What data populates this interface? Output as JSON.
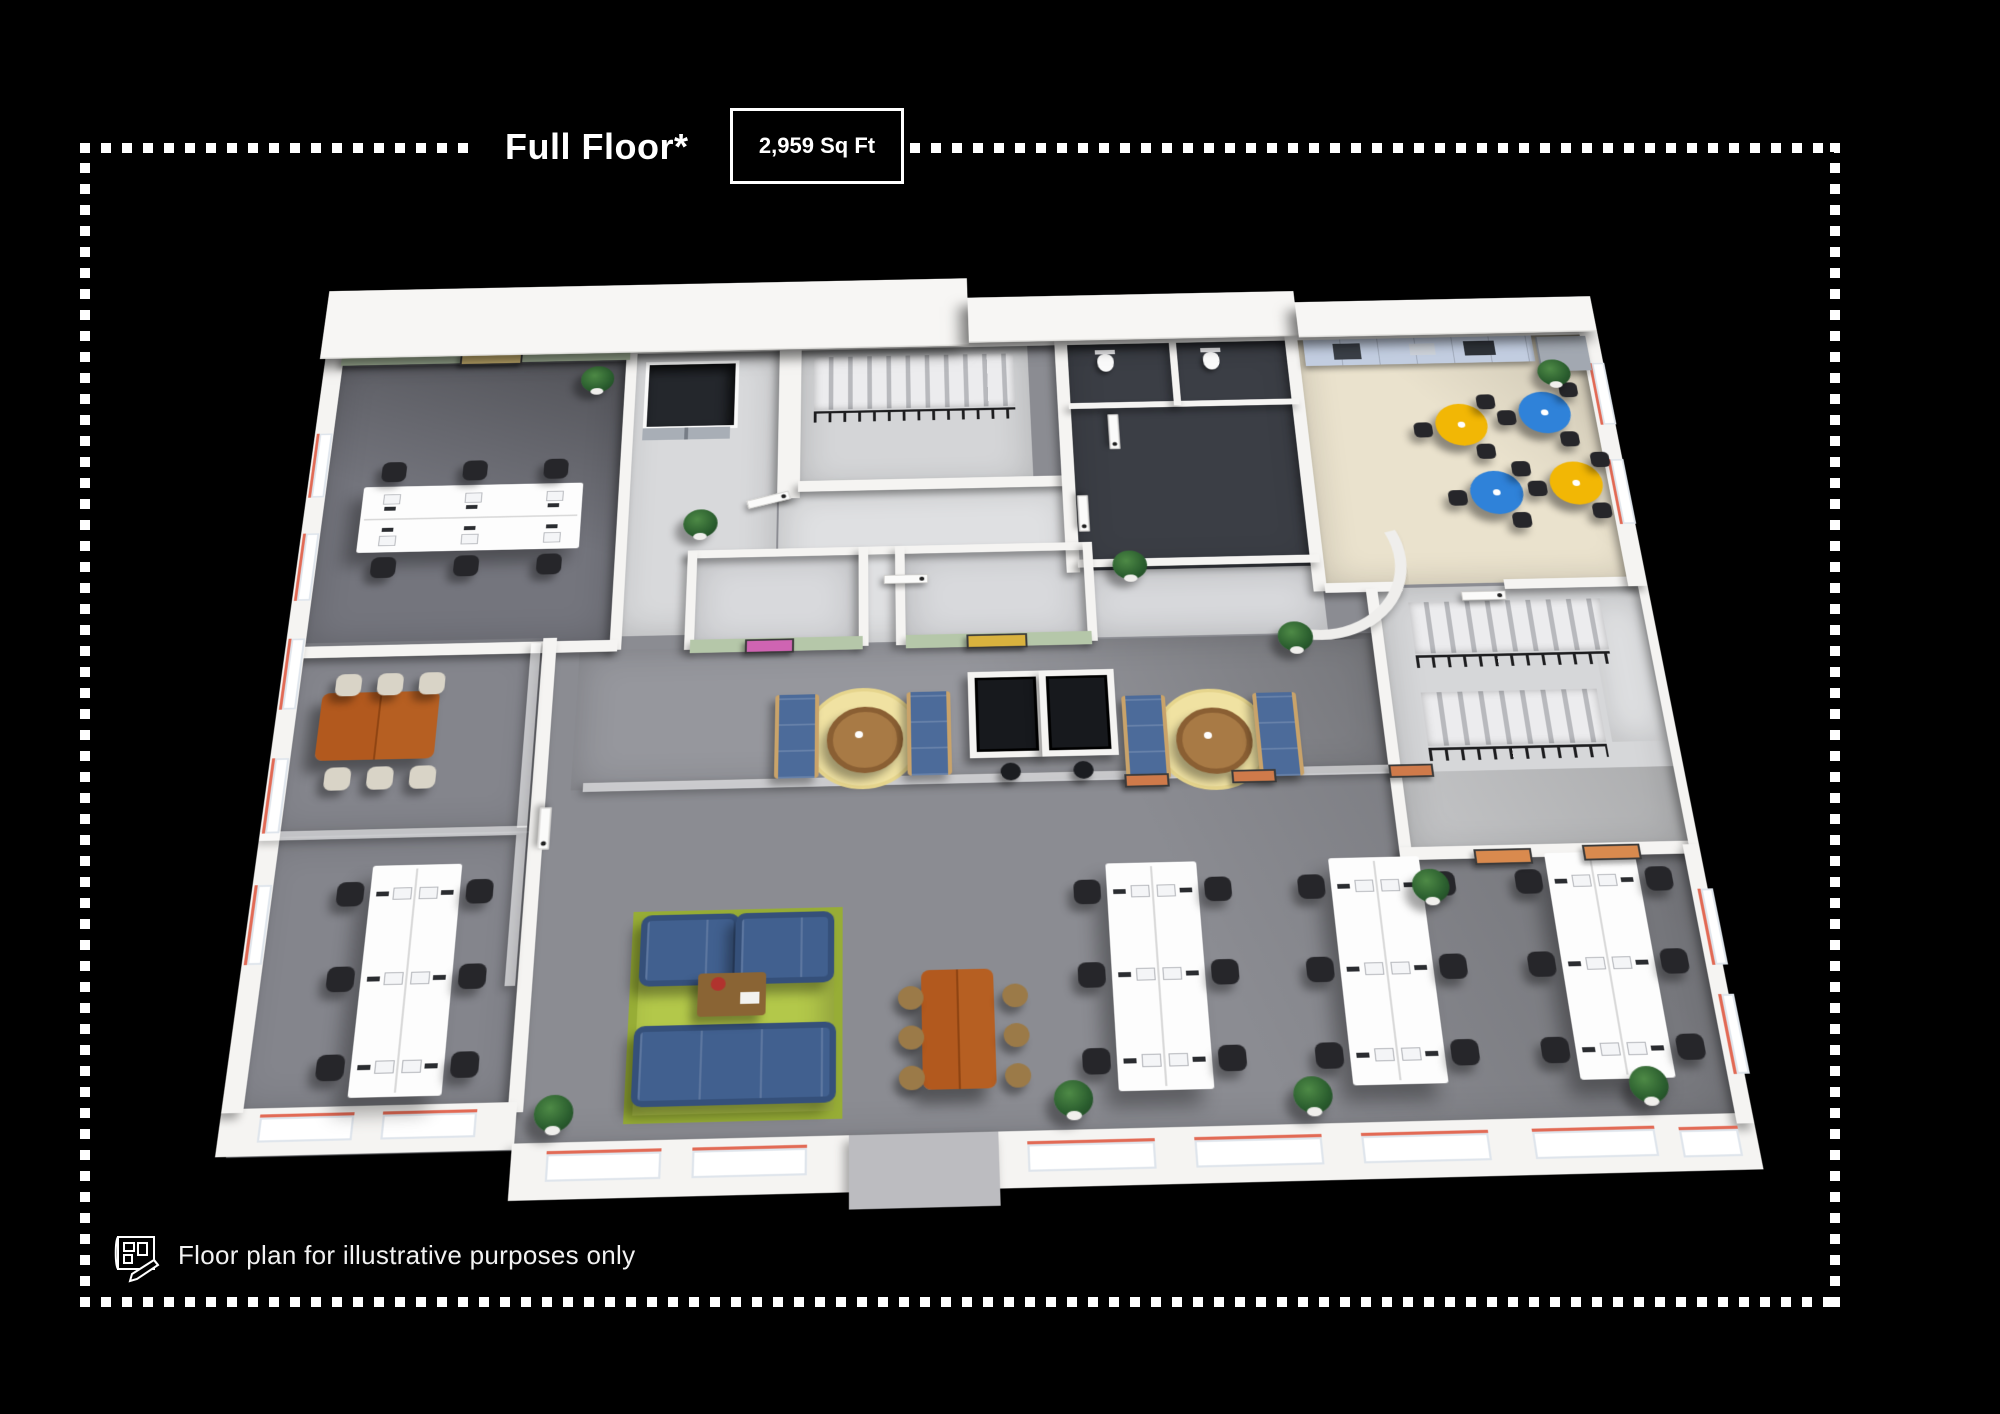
{
  "header": {
    "title": "Full Floor*",
    "area_label": "2,959 Sq Ft"
  },
  "footer": {
    "disclaimer": "Floor plan for illustrative purposes only",
    "icon": "blueprint-pencil-icon"
  },
  "palette": {
    "background": "#000000",
    "border_dots": "#ffffff",
    "accent_wall_green": "#b5c7a9",
    "carpet_gray": "#8b8c92",
    "carpet_dark": "#74757d",
    "wc_floor": "#3b3e45",
    "kitchen_tile": "#eae2cd",
    "kitchen_cabinet_blue": "#c2cde0",
    "cafe_table_yellow": "#f2b705",
    "cafe_table_blue": "#2f82d9",
    "lounge_rug_green": "#b3c84a",
    "sofa_blue": "#41608f",
    "wood_table_orange": "#b2591e",
    "nook_rug_yellow": "#f0e2a2",
    "window_trim_red": "#e26a55",
    "wall_white": "#f5f4f2",
    "chair_black": "#26262a"
  },
  "floorplan": {
    "workstations_per_bench": 6,
    "zones": [
      {
        "n": "open-office-floor",
        "t": "carpet",
        "x": 10,
        "y": 10,
        "w": 1380,
        "h": 925,
        "c": "#8b8c92"
      },
      {
        "n": "office-a-floor",
        "t": "carpet",
        "x": 18,
        "y": 18,
        "w": 312,
        "h": 372,
        "c": "#74757d"
      },
      {
        "n": "lift-lobby-floor",
        "t": "",
        "x": 330,
        "y": 18,
        "w": 168,
        "h": 368,
        "c": "#d8d9db"
      },
      {
        "n": "stair-top-floor",
        "t": "",
        "x": 520,
        "y": 18,
        "w": 250,
        "h": 190,
        "c": "#d4d5d7"
      },
      {
        "n": "hallway-floor",
        "t": "",
        "x": 500,
        "y": 208,
        "w": 312,
        "h": 192,
        "c": "#dfe0e2"
      },
      {
        "n": "wc-floor",
        "t": "",
        "x": 812,
        "y": 18,
        "w": 252,
        "h": 300,
        "c": "#3b3e45"
      },
      {
        "n": "wc-hall-floor",
        "t": "",
        "x": 812,
        "y": 318,
        "w": 252,
        "h": 82,
        "c": "#d8d9dc"
      },
      {
        "n": "kitchen-floor",
        "t": "tile",
        "x": 1066,
        "y": 18,
        "w": 330,
        "h": 326,
        "c": "#eae2cd"
      },
      {
        "n": "meeting-room-1-floor",
        "t": "",
        "x": 412,
        "y": 290,
        "w": 172,
        "h": 112,
        "c": "#d8d9dc"
      },
      {
        "n": "meeting-room-2-floor",
        "t": "",
        "x": 632,
        "y": 290,
        "w": 186,
        "h": 112,
        "c": "#d8d9dc"
      },
      {
        "n": "corridor-floor",
        "t": "carpet",
        "x": 300,
        "y": 402,
        "w": 814,
        "h": 162,
        "c": "#96979d"
      },
      {
        "n": "conference-room-floor",
        "t": "carpet",
        "x": 0,
        "y": 386,
        "w": 268,
        "h": 222,
        "c": "#84858c"
      },
      {
        "n": "wing-office-floor",
        "t": "carpet",
        "x": 0,
        "y": 610,
        "w": 268,
        "h": 284,
        "c": "#84858c"
      },
      {
        "n": "stairwell-2-floor",
        "t": "",
        "x": 1118,
        "y": 348,
        "w": 276,
        "h": 312,
        "c": "#d6d7d9"
      },
      {
        "n": "stair-landing",
        "t": "",
        "x": 1334,
        "y": 366,
        "w": 54,
        "h": 170,
        "c": "#e4e5e7"
      }
    ],
    "shadows": [
      {
        "x": 18,
        "y": 30,
        "w": 312,
        "h": 360,
        "g": "linear-gradient(200deg, rgba(0,0,0,.30), rgba(0,0,0,0) 55%)"
      },
      {
        "x": 300,
        "y": 565,
        "w": 1100,
        "h": 370,
        "g": "linear-gradient(250deg, rgba(0,0,0,.20), rgba(0,0,0,0) 45%)"
      },
      {
        "x": 300,
        "y": 402,
        "w": 814,
        "h": 162,
        "g": "linear-gradient(250deg, rgba(0,0,0,.22), rgba(0,0,0,0) 50%)"
      },
      {
        "x": 1066,
        "y": 18,
        "w": 330,
        "h": 326,
        "g": "linear-gradient(230deg, rgba(0,0,0,.14), rgba(0,0,0,0) 45%)"
      }
    ],
    "stairs": [
      [
        536,
        30,
        218,
        72
      ],
      [
        1150,
        366,
        198,
        62
      ],
      [
        1150,
        474,
        178,
        62
      ]
    ],
    "railings": [
      [
        536,
        104,
        218,
        12
      ],
      [
        1150,
        430,
        198,
        12
      ],
      [
        1150,
        538,
        178,
        12
      ]
    ],
    "walls": [
      [
        8,
        6,
        1384,
        14
      ],
      [
        330,
        10,
        12,
        392
      ],
      [
        14,
        390,
        324,
        14
      ],
      [
        498,
        10,
        24,
        208
      ],
      [
        520,
        196,
        292,
        14
      ],
      [
        800,
        10,
        14,
        310
      ],
      [
        1054,
        10,
        14,
        340
      ],
      [
        812,
        304,
        252,
        10
      ],
      [
        1066,
        340,
        80,
        12
      ],
      [
        1252,
        340,
        144,
        12
      ],
      [
        406,
        282,
        418,
        10
      ],
      [
        406,
        282,
        10,
        122
      ],
      [
        584,
        282,
        10,
        122
      ],
      [
        622,
        282,
        10,
        122
      ],
      [
        818,
        282,
        10,
        122
      ],
      [
        1108,
        348,
        12,
        312
      ],
      [
        1108,
        648,
        290,
        14
      ],
      [
        1390,
        348,
        10,
        304
      ],
      [
        262,
        386,
        14,
        512
      ],
      [
        0,
        888,
        270,
        46
      ],
      [
        268,
        928,
        1132,
        54
      ],
      [
        0,
        8,
        20,
        884
      ],
      [
        1380,
        16,
        20,
        336
      ],
      [
        1384,
        652,
        16,
        286
      ],
      [
        812,
        100,
        250,
        8
      ],
      [
        926,
        18,
        8,
        88
      ]
    ],
    "entry_block": [
      574,
      928,
      136,
      70
    ],
    "green_walls": [
      [
        18,
        12,
        316,
        16
      ],
      [
        412,
        392,
        176,
        16
      ],
      [
        632,
        392,
        190,
        16
      ]
    ],
    "glass": [
      [
        250,
        392,
        10,
        212
      ],
      [
        0,
        602,
        260,
        10
      ],
      [
        312,
        556,
        800,
        10
      ],
      [
        250,
        612,
        10,
        160
      ]
    ],
    "curve_wall": [
      960,
      215,
      170,
      170
    ],
    "windows": [
      [
        300,
        936,
        104,
        26,
        0
      ],
      [
        432,
        936,
        104,
        26,
        0
      ],
      [
        736,
        938,
        116,
        26,
        0
      ],
      [
        888,
        938,
        116,
        26,
        0
      ],
      [
        1040,
        938,
        116,
        26,
        0
      ],
      [
        1196,
        938,
        112,
        26,
        0
      ],
      [
        1330,
        940,
        54,
        26,
        0
      ],
      [
        36,
        894,
        86,
        24,
        0
      ],
      [
        148,
        894,
        86,
        24,
        0
      ],
      [
        2,
        120,
        14,
        84,
        1
      ],
      [
        2,
        250,
        14,
        84,
        1
      ],
      [
        2,
        380,
        14,
        84,
        1
      ],
      [
        2,
        520,
        14,
        84,
        1
      ],
      [
        2,
        660,
        14,
        84,
        1
      ],
      [
        1384,
        60,
        14,
        84,
        1
      ],
      [
        1384,
        190,
        14,
        84,
        1
      ],
      [
        1390,
        700,
        12,
        80,
        1
      ],
      [
        1390,
        810,
        12,
        80,
        1
      ]
    ],
    "elevator": {
      "shaft": [
        352,
        32,
        94,
        84
      ],
      "doors": [
        352,
        122,
        94,
        16
      ]
    },
    "cabinets": {
      "run": [
        1074,
        20,
        252,
        36
      ],
      "items": [
        [
          1106,
          26,
          30,
          22,
          "#3a3f46"
        ],
        [
          1190,
          28,
          28,
          16,
          "#ccd1d8"
        ],
        [
          1250,
          26,
          34,
          20,
          "#2e3238"
        ]
      ],
      "fridge": [
        1330,
        22,
        54,
        48,
        "#a2a8b1"
      ]
    },
    "benches": [
      {
        "x": 60,
        "y": 192,
        "w": 232,
        "h": 84,
        "o": "h"
      },
      {
        "x": 114,
        "y": 642,
        "w": 86,
        "h": 238,
        "o": "v"
      },
      {
        "x": 822,
        "y": 658,
        "w": 88,
        "h": 234,
        "o": "v"
      },
      {
        "x": 1038,
        "y": 658,
        "w": 88,
        "h": 234,
        "o": "v"
      },
      {
        "x": 1248,
        "y": 658,
        "w": 88,
        "h": 234,
        "o": "v"
      }
    ],
    "conference": {
      "table": [
        44,
        446,
        118,
        78
      ],
      "chairs": [
        [
          56,
          424
        ],
        [
          98,
          424
        ],
        [
          140,
          424
        ],
        [
          56,
          532
        ],
        [
          98,
          532
        ],
        [
          140,
          532
        ]
      ]
    },
    "lounge": {
      "rug": [
        368,
        698,
        184,
        198
      ],
      "armchairs": [
        [
          376,
          702,
          82,
          62
        ],
        [
          466,
          702,
          82,
          62
        ]
      ],
      "sofa": [
        374,
        816,
        176,
        68
      ],
      "coffee_table": [
        432,
        764,
        64,
        44
      ],
      "flowers": [
        444,
        768
      ],
      "magazine": [
        472,
        784
      ]
    },
    "wood_table": {
      "table": [
        642,
        766,
        68,
        120
      ],
      "chairs": [
        [
          620,
          782
        ],
        [
          620,
          822
        ],
        [
          620,
          862
        ],
        [
          718,
          782
        ],
        [
          718,
          822
        ],
        [
          718,
          862
        ]
      ]
    },
    "cafe_tables": [
      {
        "x": 1206,
        "y": 112,
        "c": "#f2b705"
      },
      {
        "x": 1298,
        "y": 98,
        "c": "#2f82d9"
      },
      {
        "x": 1232,
        "y": 202,
        "c": "#2f82d9"
      },
      {
        "x": 1318,
        "y": 192,
        "c": "#f2b705"
      }
    ],
    "cafe_chair_offsets": [
      [
        -42,
        6
      ],
      [
        30,
        -30
      ],
      [
        22,
        36
      ]
    ],
    "nooks": [
      [
        584,
        508
      ],
      [
        932,
        518
      ]
    ],
    "panels": [
      [
        694,
        438
      ],
      [
        766,
        438
      ]
    ],
    "stools": [
      [
        724,
        544
      ],
      [
        796,
        544
      ]
    ],
    "toilets": [
      [
        846,
        34
      ],
      [
        962,
        34
      ]
    ],
    "arts": [
      {
        "x": 148,
        "y": 13,
        "w": 64,
        "h": 14,
        "c": "#e3c87e"
      },
      {
        "x": 468,
        "y": 393,
        "w": 46,
        "h": 13,
        "c": "#cf64b2"
      },
      {
        "x": 694,
        "y": 393,
        "w": 58,
        "h": 13,
        "c": "#d9b23e"
      },
      {
        "x": 846,
        "y": 560,
        "w": 40,
        "h": 11,
        "c": "#cf7a4a"
      },
      {
        "x": 952,
        "y": 558,
        "w": 40,
        "h": 11,
        "c": "#cf7a4a"
      },
      {
        "x": 1108,
        "y": 556,
        "w": 40,
        "h": 11,
        "c": "#cf7a4a"
      },
      {
        "x": 1180,
        "y": 652,
        "w": 52,
        "h": 13,
        "c": "#d98a4e"
      },
      {
        "x": 1286,
        "y": 650,
        "w": 52,
        "h": 13,
        "c": "#d98a4e"
      }
    ],
    "doors": [
      [
        466,
        214,
        -15
      ],
      [
        610,
        318,
        0
      ],
      [
        798,
        240,
        90
      ],
      [
        836,
        134,
        90
      ],
      [
        254,
        600,
        90
      ],
      [
        1206,
        354,
        0
      ]
    ],
    "plants": [
      [
        300,
        54
      ],
      [
        418,
        248
      ],
      [
        1030,
        404
      ],
      [
        1344,
        72
      ],
      [
        1134,
        690
      ],
      [
        304,
        900
      ],
      [
        780,
        898
      ],
      [
        1000,
        900
      ],
      [
        1310,
        898
      ],
      [
        866,
        312
      ]
    ],
    "roofs": [
      [
        -6,
        -78,
        712,
        94
      ],
      [
        706,
        -50,
        364,
        62
      ],
      [
        1070,
        -34,
        330,
        48
      ]
    ]
  }
}
